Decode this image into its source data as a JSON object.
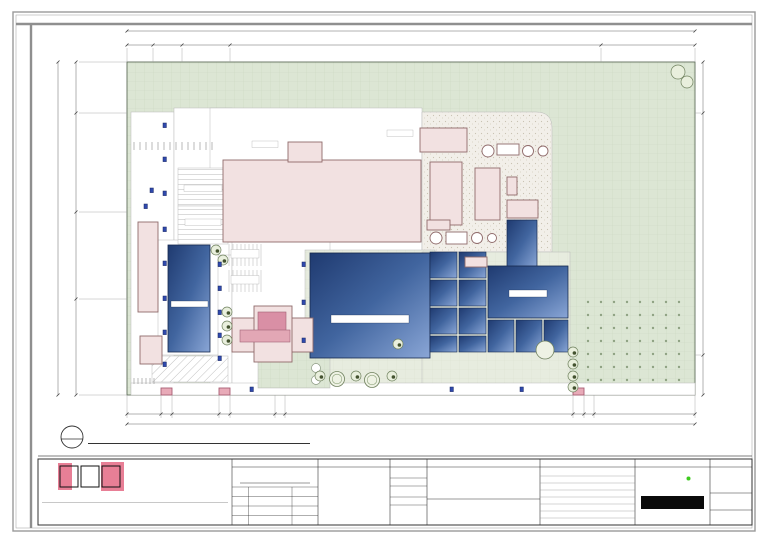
{
  "sheet": {
    "ref_number": "1",
    "ref_sheet": "A-SDP-01",
    "title": "SITE DEVELOPMENT PLAN",
    "scale_label": "SCALE",
    "scale_value": "1:1500M"
  },
  "dimensions": {
    "top_overall": "430.00",
    "top_segments": [
      "20.00",
      "21.30",
      "36.30",
      "280.80",
      "71.80"
    ],
    "bottom_overall": "430.00",
    "bottom_segments": [
      "26.00",
      "7.80",
      "36.00",
      "7.80",
      "34.00",
      "8.00",
      "218.00",
      "8.00",
      "7.80",
      "71.80"
    ],
    "left_overall": "270.00",
    "left_segments": [
      "41.20",
      "80.56",
      "70.50",
      "77.74"
    ],
    "right_segments": [
      "41.20",
      "196.30",
      "32.50"
    ]
  },
  "plan": {
    "loading_bay": "LOADING BAY",
    "medical_waste": [
      "MEDICAL",
      "WASTE"
    ],
    "plant_processing_building": "PLANT PROCESSING BUILDING",
    "ash_bunker": "ASH BUNKER",
    "boiler_bldg": "BOILER BLDG",
    "turbine_bldg": [
      "TURBINE",
      "BLDG"
    ],
    "condenser": "CONDENSER",
    "cooling_tower": "COOLING TOWER",
    "scrubber_1": [
      "SCRUBBER",
      "1"
    ],
    "baghouse_1": [
      "BAGHOUSE",
      "1"
    ],
    "stack_1": [
      "STACK",
      "1"
    ],
    "fly_ash_1": [
      "FLY",
      "ASH 1"
    ],
    "scrubber_2": [
      "SCRUBBER",
      "2"
    ],
    "baghouse_2": [
      "BAGHOUSE",
      "2"
    ],
    "stack_2": [
      "STACK",
      "2"
    ],
    "fly_ash_2": [
      "FLY",
      "ASH 2"
    ],
    "pumping_station": [
      "PUMPING",
      "STATION"
    ],
    "reservoir": "RESERVOIR",
    "filtration_tank": "FILTRATION TANK",
    "rain_water_pond": "RAIN WATER COLLECTION POND",
    "weighing_area": "WEIGHING AREA",
    "queuing_area": "QUEUING AREA",
    "unloading_bay": "UNLOADING BAY",
    "sanitation_area": "SANITATION AREA",
    "security_pmo": [
      "SECURITY",
      "AND",
      "P.M.O."
    ],
    "admin_building": "ADMIN BUILDING",
    "recreation_area": [
      "RECREATION",
      "AREA"
    ],
    "plant_personnel_parking": [
      "PLANT PERSONNEL",
      "PARKING"
    ],
    "admin_visitor_parking": [
      "ADMIN AND VISITOR",
      "PARKING"
    ],
    "motorized_gate": "MOTORIZED SLIDING GATE",
    "gates": [
      {
        "lines": [
          "GATE 1",
          "GARBAGE TRUCK",
          "ENTRY AND EXIT"
        ]
      },
      {
        "lines": [
          "GATE 2",
          "EMPLOYEE AND VISITOR",
          "ENTRY AND EXIT"
        ]
      },
      {
        "lines": [
          "GATE 3",
          "MAINTENANCE SERVICE",
          "ENTRY AND EXIT"
        ]
      }
    ]
  },
  "title_block": {
    "firm": {
      "logo_letters": [
        "A",
        "A",
        "S"
      ],
      "name": "ALMUETE ARCHITECTURAL SERVICES",
      "address_lines": [
        "Address: #93, Maligaya, Abogado, Paniqui, Tarlac",
        "Viber and WhatsApp: +63 905 444 9002",
        "Call and Text: +63 928 438 3548",
        "Email: r.a.almuete@gmail.com"
      ],
      "disclaimer": "THIS DRAWING AS AN INSTRUMENT OF SERVICE IS THE PROPERTY OF AAS, AND AS SUCH MUST NOT BE REPRODUCED OR COPIED IN PART OR IN WHOLE WITHOUT THE PERMISSION OF THE AUTHOR."
    },
    "architect": {
      "header": "ARCHITECT",
      "name": "RUSTUM E. ALMUETE, I",
      "rows": [
        {
          "label": "PRC",
          "value": "22091"
        },
        {
          "label": "PTR",
          "value": "4117257"
        },
        {
          "label": "DATE",
          "value": "FEB 4, 2021"
        },
        {
          "label": "PLACE",
          "value": "PANIQUI, TARLAC"
        }
      ]
    },
    "ra_notice": {
      "header": "RA 9266",
      "body": "Ownership of Plans, Specifications, and other Construction Documents. Drawings and Specifications and other contract documents are duly signed, stamped or sealed, as instruments of service, are the intellectual property and documents of the Architect, whether the object for which they are made is executed or not. It is unlawful for any person to duplicate or to make copies of said documents for use in the repetition of and for other projects or buildings, whether executed partly or in whole, without the written consent of the Architect or author of said documents."
    },
    "credits": {
      "cad_by_label": "CAD. BY:",
      "cad_by": "AJRB",
      "checked_by_label": "CHECKED BY:",
      "checked_by": "REA",
      "project_no_label": "PROJECT NO.",
      "project_no": "RE-01-1022-08"
    },
    "project": {
      "title_header": "PROJECT TITLE",
      "title_lines": [
        "A PROPOSED",
        "WASTE TO ENERGY",
        "FACILITY COMPLEX"
      ],
      "location_header": "PROJECT LOCATION",
      "location": "BRGY. DILA BAY, LAGUNA, PHILIPPINES"
    },
    "sheet_contents": {
      "header": "SHEET CONTENTS",
      "entry": "SITE DEVELOPMENT PLAN"
    },
    "owner": {
      "header": "OWNER",
      "logo_primary": "MAXI",
      "logo_secondary": "ENERGY"
    },
    "sheet_no": {
      "header": "SHEET NO.",
      "discipline": "A",
      "number": "SDP-01",
      "submitted_label": "SUBMITTED",
      "submitted_date": "05/03/21",
      "place": "BAGUIO CITY"
    }
  },
  "footer_note": "PROTECTED BY COPYRIGHT LAW",
  "colors": {
    "building_pink": "#f2e1e1",
    "accent_pink": "#e87f96",
    "pond_blue": "#3a5fa0",
    "grass_green": "#dce6d4",
    "maxi_green": "#3ecb1e"
  }
}
